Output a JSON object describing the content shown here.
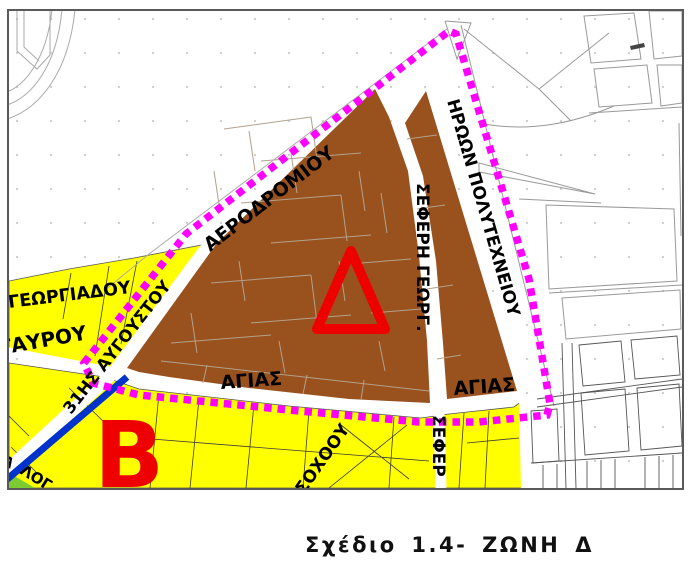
{
  "caption": "Σχέδιο 1.4- ΖΩΝΗ Δ",
  "markers": {
    "zone_delta": "Δ",
    "zone_beta": "Β"
  },
  "street_labels": {
    "aerodromiou": "ΑΕΡΟΔΡΟΜΙΟΥ",
    "iroon_polytechneiou": "ΗΡΩΩΝ ΠΟΛΥΤΕΧΝΕΙΟΥ",
    "seferi_georg": "ΣΕΦΕΡΗ ΓΕΩΡΓ.",
    "sefer": "ΣΕΦΕΡ",
    "agias_1": "ΑΓΙΑΣ",
    "agias_2": "ΑΓΙΑΣ",
    "georgiadou": "ΓΕΩΡΓΙΑΔΟΥ",
    "tavrou": "ΤΑΥΡΟΥ",
    "avgoustou_31is": "31ΗΣ ΑΥΓΟΥΣΤΟΥ",
    "soxoou": "ΣΟΧΟΟΥ",
    "log_fragment": "ΛΟΓ",
    "lambda_fragment": "Λ"
  },
  "colors": {
    "zone_brown": "#99511E",
    "zone_yellow": "#FFFF00",
    "boundary_magenta": "#FF00FF",
    "road_blue": "#0033CC",
    "marker_red": "#EE0000",
    "green_area": "#7CCB33",
    "street_outline_gray": "#999999",
    "frame_gray": "#5A5A5A"
  }
}
